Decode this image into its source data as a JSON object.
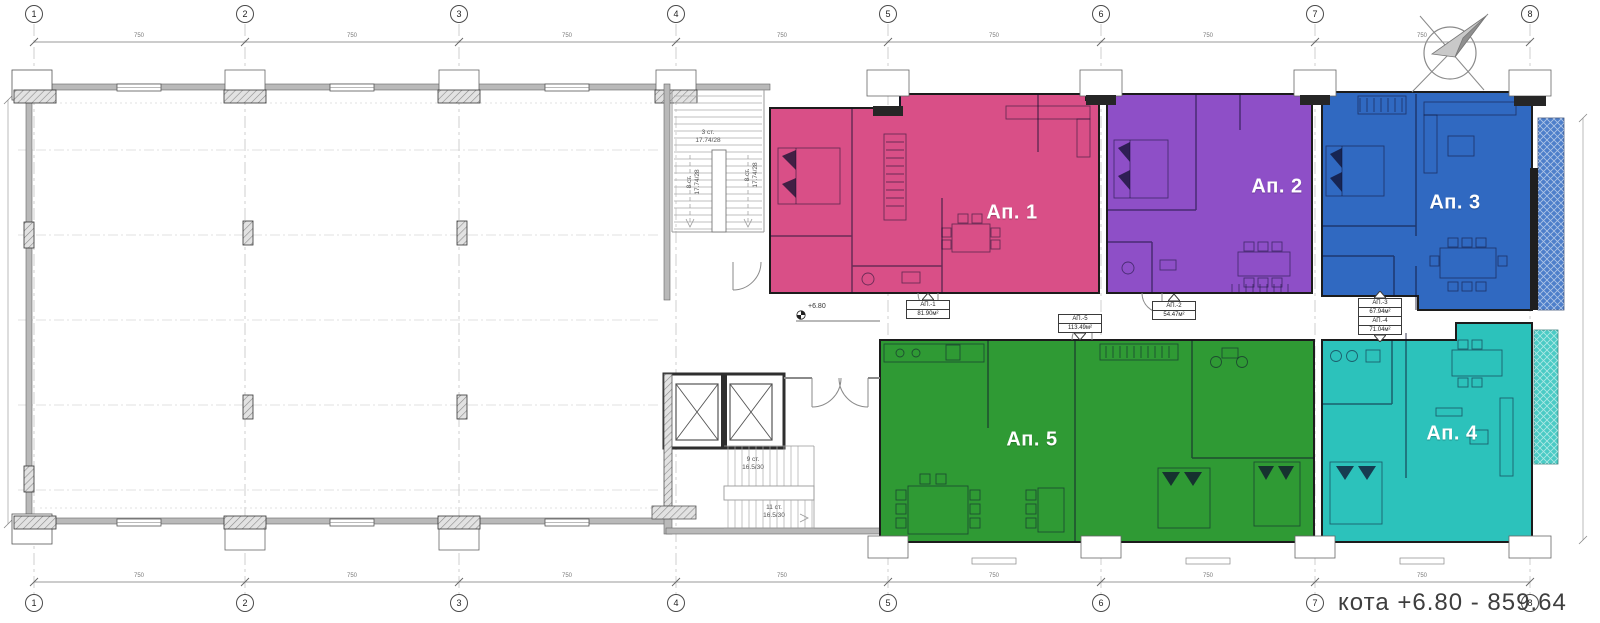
{
  "plan": {
    "caption": "кота +6.80 - 859.64",
    "level_marker": "+6.80",
    "bay_dimension": "750"
  },
  "grid_columns": [
    "1",
    "2",
    "3",
    "4",
    "5",
    "6",
    "7",
    "8"
  ],
  "apartments": [
    {
      "name": "Ап. 1",
      "tag_name": "АП.-1",
      "tag_area": "81.90м²",
      "color": "#d94f87"
    },
    {
      "name": "Ап. 2",
      "tag_name": "АП.-2",
      "tag_area": "54.47м²",
      "color": "#8e4fc7"
    },
    {
      "name": "Ап. 3",
      "tag_name": "АП.-3",
      "tag_area": "67.94м²",
      "color": "#3069c1"
    },
    {
      "name": "Ап. 4",
      "tag_name": "АП.-4",
      "tag_area": "71.04м²",
      "color": "#2cc2bb"
    },
    {
      "name": "Ап. 5",
      "tag_name": "АП.-5",
      "tag_area": "113.49м²",
      "color": "#2f9a34"
    }
  ],
  "stairs": {
    "flight3_steps": "3 ст.",
    "flight3_dims": "17.74/28",
    "flight8_steps": "8 ст.",
    "flight8_dims": "17.74/28",
    "flight9_steps": "9 ст.",
    "flight9_dims": "16.5/30",
    "flight11_steps": "11 ст.",
    "flight11_dims": "16.5/30"
  }
}
